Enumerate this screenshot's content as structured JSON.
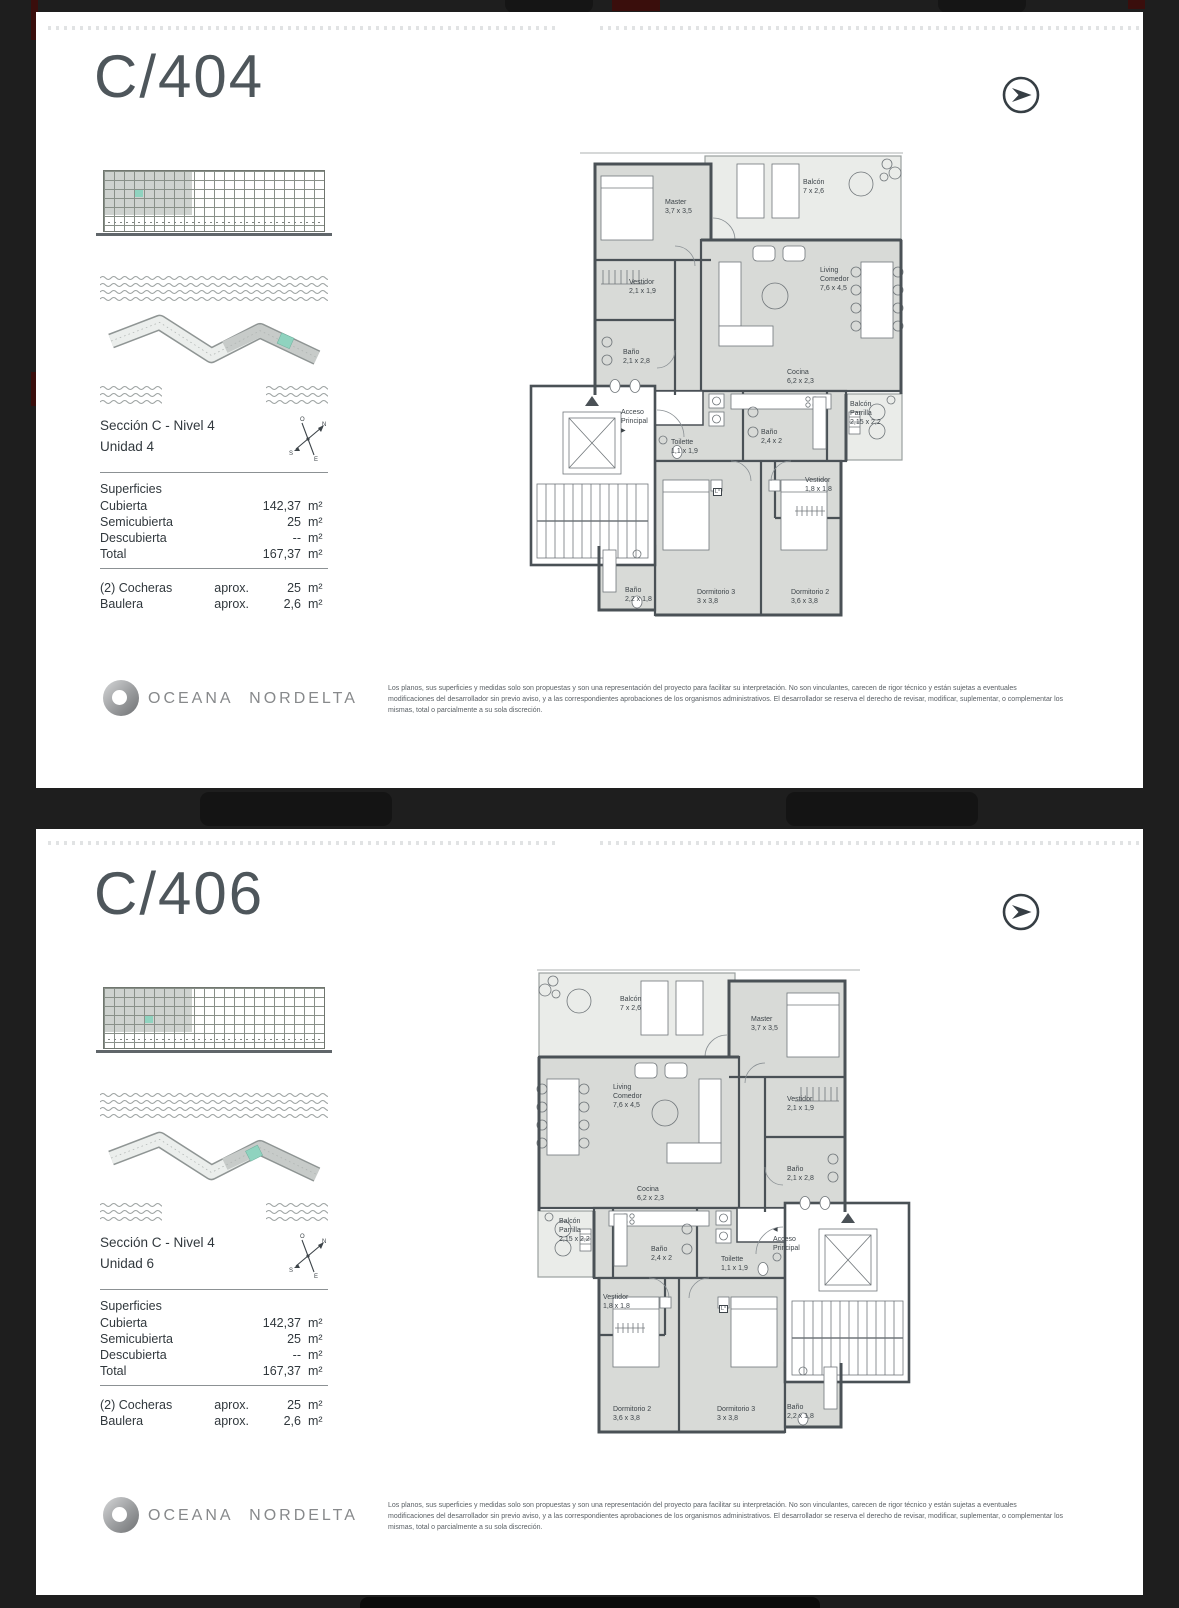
{
  "viewer": {
    "background": "#1e1e1e",
    "red_accent": "#3a0e0c",
    "teal_highlight": "#8fd3bf"
  },
  "brand": {
    "name": "OCEANA NORDELTA"
  },
  "labels": {
    "superficies": "Superficies"
  },
  "compass": {
    "top": "O",
    "right": "N",
    "left": "S",
    "bottom": "E"
  },
  "disclaimer": "Los planos, sus superficies y medidas solo son propuestas y son una representación del proyecto para facilitar su interpretación. No son vinculantes, carecen de rigor técnico y están sujetas a eventuales modificaciones del desarrollador sin previo aviso, y a las correspondientes aprobaciones de los organismos administrativos. El desarrollador se reserva el derecho de revisar, modificar, suplementar, o complementar los mismas, total o parcialmente a su sola discreción.",
  "pages": [
    {
      "title": "C/404",
      "section_line1": "Sección C - Nivel 4",
      "section_line2": "Unidad 4",
      "superficies": [
        {
          "label": "Cubierta",
          "value": "142,37",
          "unit": "m²"
        },
        {
          "label": "Semicubierta",
          "value": "25",
          "unit": "m²"
        },
        {
          "label": "Descubierta",
          "value": "--",
          "unit": "m²"
        },
        {
          "label": "Total",
          "value": "167,37",
          "unit": "m²"
        }
      ],
      "extras": [
        {
          "label": "(2) Cocheras",
          "qualifier": "aprox.",
          "value": "25",
          "unit": "m²"
        },
        {
          "label": "Baulera",
          "qualifier": "aprox.",
          "value": "2,6",
          "unit": "m²"
        }
      ],
      "rooms": {
        "master": {
          "name": "Master",
          "dims": "3,7 x 3,5"
        },
        "balcon": {
          "name": "Balcón",
          "dims": "7 x 2,6"
        },
        "vestidor1": {
          "name": "Vestidor",
          "dims": "2,1 x 1,9"
        },
        "bano_m": {
          "name": "Baño",
          "dims": "2,1 x 2,8"
        },
        "living": {
          "name": "Living Comedor",
          "dims": "7,6 x 4,5"
        },
        "cocina": {
          "name": "Cocina",
          "dims": "6,2 x 2,3"
        },
        "acceso": {
          "name": "Acceso Principal",
          "dims": ""
        },
        "toilette": {
          "name": "Toilette",
          "dims": "1,1 x 1,9"
        },
        "bano2": {
          "name": "Baño",
          "dims": "2,4 x 2"
        },
        "parrilla": {
          "name": "Balcón Parrilla",
          "dims": "2,15 x 2,2"
        },
        "vestidor2": {
          "name": "Vestidor",
          "dims": "1,8 x 1,8"
        },
        "dorm3": {
          "name": "Dormitorio 3",
          "dims": "3 x 3,8"
        },
        "dorm2": {
          "name": "Dormitorio 2",
          "dims": "3,6 x 3,8"
        },
        "bano3": {
          "name": "Baño",
          "dims": "2,2 x 1,8"
        },
        "l_label": {
          "name": "L°",
          "dims": ""
        }
      }
    },
    {
      "title": "C/406",
      "section_line1": "Sección C - Nivel 4",
      "section_line2": "Unidad 6",
      "superficies": [
        {
          "label": "Cubierta",
          "value": "142,37",
          "unit": "m²"
        },
        {
          "label": "Semicubierta",
          "value": "25",
          "unit": "m²"
        },
        {
          "label": "Descubierta",
          "value": "--",
          "unit": "m²"
        },
        {
          "label": "Total",
          "value": "167,37",
          "unit": "m²"
        }
      ],
      "extras": [
        {
          "label": "(2) Cocheras",
          "qualifier": "aprox.",
          "value": "25",
          "unit": "m²"
        },
        {
          "label": "Baulera",
          "qualifier": "aprox.",
          "value": "2,6",
          "unit": "m²"
        }
      ],
      "rooms": {
        "master": {
          "name": "Master",
          "dims": "3,7 x 3,5"
        },
        "balcon": {
          "name": "Balcón",
          "dims": "7 x 2,6"
        },
        "vestidor1": {
          "name": "Vestidor",
          "dims": "2,1 x 1,9"
        },
        "bano_m": {
          "name": "Baño",
          "dims": "2,1 x 2,8"
        },
        "living": {
          "name": "Living Comedor",
          "dims": "7,6 x 4,5"
        },
        "cocina": {
          "name": "Cocina",
          "dims": "6,2 x 2,3"
        },
        "acceso": {
          "name": "Acceso Principal",
          "dims": ""
        },
        "toilette": {
          "name": "Toilette",
          "dims": "1,1 x 1,9"
        },
        "bano2": {
          "name": "Baño",
          "dims": "2,4 x 2"
        },
        "parrilla": {
          "name": "Balcón Parrilla",
          "dims": "2,15 x 2,2"
        },
        "vestidor2": {
          "name": "Vestidor",
          "dims": "1,8 x 1,8"
        },
        "dorm3": {
          "name": "Dormitorio 3",
          "dims": "3 x 3,8"
        },
        "dorm2": {
          "name": "Dormitorio 2",
          "dims": "3,6 x 3,8"
        },
        "bano3": {
          "name": "Baño",
          "dims": "2,2 x 1,8"
        },
        "l_label": {
          "name": "L°",
          "dims": ""
        }
      }
    }
  ]
}
